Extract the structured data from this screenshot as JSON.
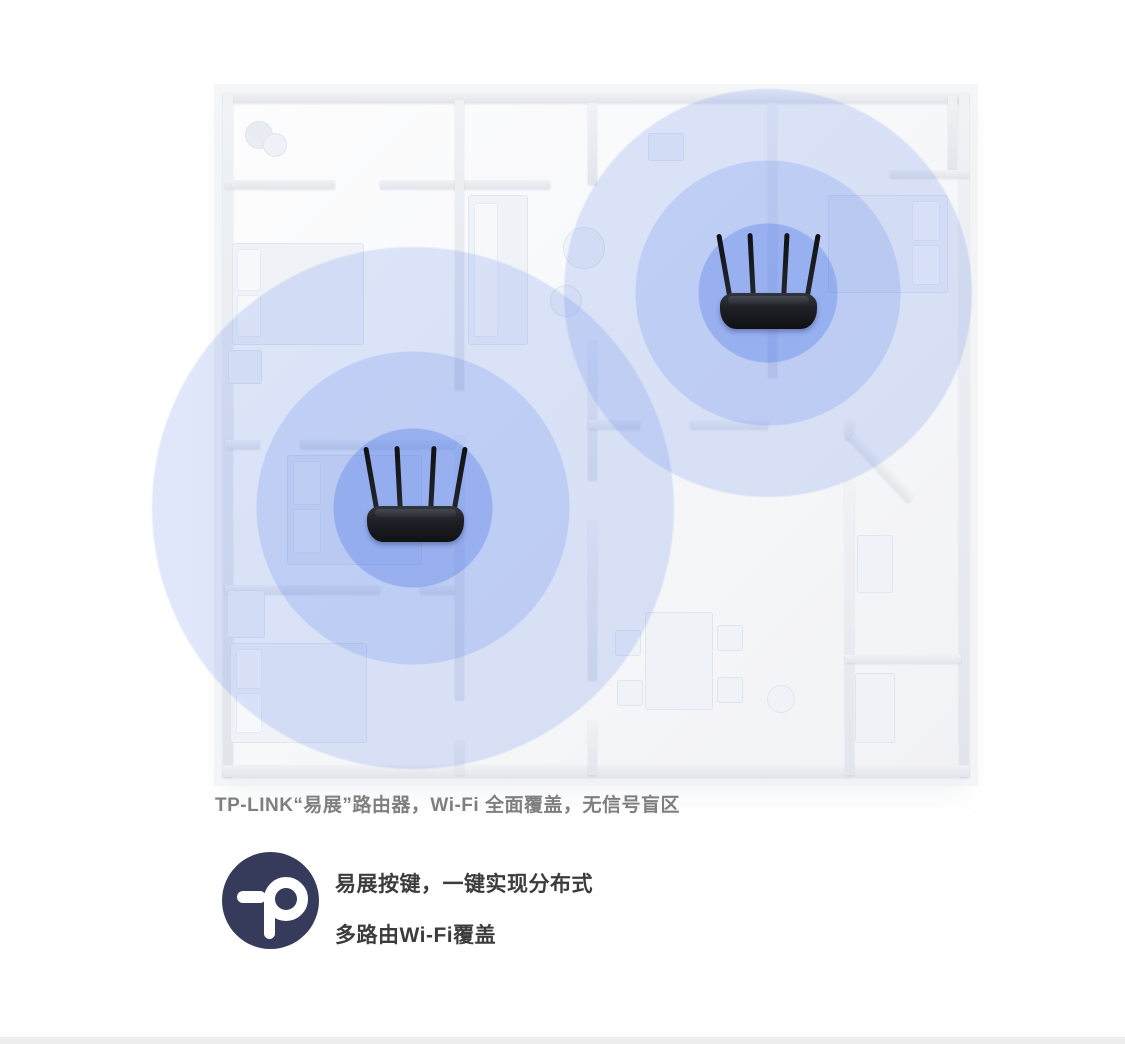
{
  "caption": {
    "text": "TP-LINK“易展”路由器，Wi-Fi 全面覆盖，无信号盲区"
  },
  "feature": {
    "line1": "易展按键，一键实现分布式",
    "line2": "多路由Wi-Fi覆盖"
  },
  "logo": {
    "glyph": "tp",
    "background": "#363b5b"
  },
  "wifi": {
    "accent_rgb": "64,110,230",
    "band_alphas": [
      0.52,
      0.31,
      0.165
    ],
    "coverage": [
      {
        "router": "living-room-router",
        "cx": 413,
        "cy": 508,
        "radii": [
          80,
          157,
          262
        ]
      },
      {
        "router": "bedroom-router",
        "cx": 768,
        "cy": 293,
        "radii": [
          70,
          133,
          205
        ]
      }
    ]
  },
  "routers": [
    {
      "name": "living-room-router",
      "left": 367,
      "top": 445
    },
    {
      "name": "bedroom-router",
      "left": 720,
      "top": 232
    }
  ],
  "footer_bar": {
    "color": "#ededed"
  }
}
